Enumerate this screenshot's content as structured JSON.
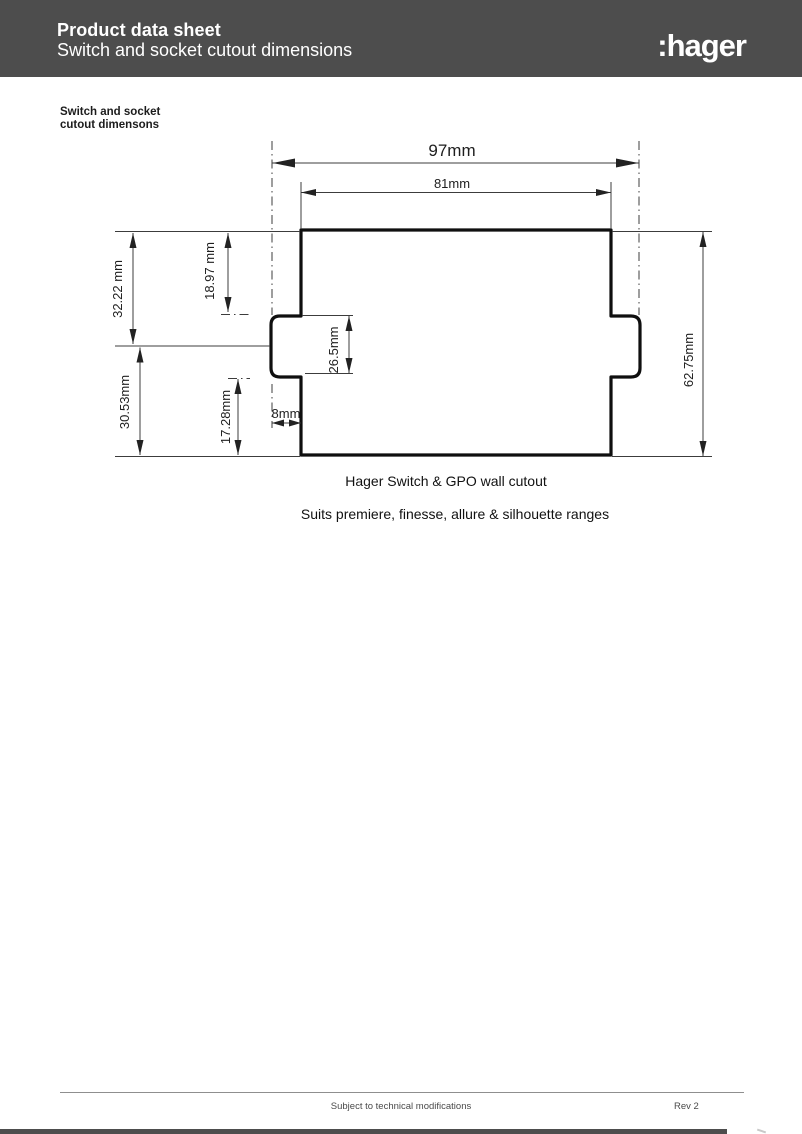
{
  "header": {
    "title": "Product data sheet",
    "subtitle": "Switch and socket cutout dimensions",
    "brand": ":hager"
  },
  "side_label": {
    "line1": "Switch and socket",
    "line2": "cutout dimensons"
  },
  "diagram": {
    "dims": {
      "outer_width": "97mm",
      "inner_width": "81mm",
      "upper_left_outer": "32.22 mm",
      "upper_left_inner": "18.97 mm",
      "lower_left_outer": "30.53mm",
      "lower_left_inner": "17.28mm",
      "notch_height": "26.5mm",
      "notch_depth": "8mm",
      "total_height": "62.75mm"
    },
    "caption": "Hager Switch & GPO wall cutout",
    "subcaption": "Suits premiere, finesse, allure & silhouette ranges"
  },
  "footer": {
    "note": "Subject to technical modifications",
    "revision": "Rev 2"
  },
  "colors": {
    "header_bar": "#4d4d4d",
    "outline": "#0f0f0f",
    "thin_line": "#3c3c3c"
  }
}
